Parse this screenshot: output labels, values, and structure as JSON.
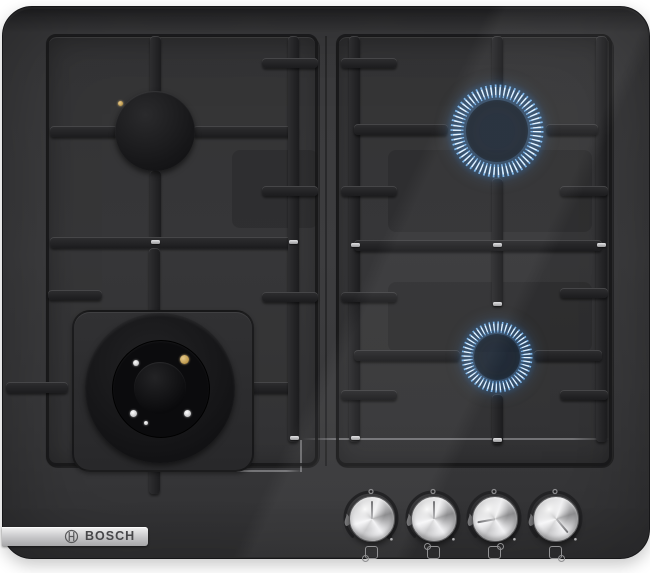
{
  "brand": {
    "name": "BOSCH",
    "logo_icon": "bosch-armature-icon"
  },
  "appliance": {
    "kind": "built-in 4-burner gas hob",
    "surface": "black tempered glass",
    "burner_count": 4,
    "knob_count": 4
  },
  "colors": {
    "glass": "#3b3b3d",
    "grid_iron": "#232325",
    "flame_tip": "#eaf6ff",
    "flame_body": "#7db6ea",
    "flame_glow": "#2f7fd4",
    "knob_metal": "#d9d9db",
    "badge_metal": "#c6c6c8",
    "igniter_brass": "#b58f4e"
  },
  "burners": [
    {
      "name": "back-left",
      "position": "top-left",
      "kind": "standard cap burner",
      "lit": false
    },
    {
      "name": "back-right",
      "position": "top-right",
      "kind": "standard burner",
      "lit": true
    },
    {
      "name": "front-left",
      "position": "bottom-left",
      "kind": "wok dual-flame burner",
      "lit": false
    },
    {
      "name": "front-right",
      "position": "bottom-right",
      "kind": "standard burner",
      "lit": true
    }
  ],
  "knobs": [
    {
      "label": "front-left burner knob",
      "state": "off",
      "pointer_deg": 0,
      "position_icon": "dot-bottom-left"
    },
    {
      "label": "back-left burner knob",
      "state": "off",
      "pointer_deg": 0,
      "position_icon": "dot-top-left"
    },
    {
      "label": "back-right burner knob",
      "state": "on",
      "pointer_deg": -100,
      "position_icon": "dot-top-right"
    },
    {
      "label": "front-right burner knob",
      "state": "on",
      "pointer_deg": 140,
      "position_icon": "dot-bottom-right"
    }
  ],
  "knob_markings": {
    "top_marker": "off-position-dot",
    "left_marker": "large-flame-icon",
    "arc_end_marker": "small-flame-dot"
  }
}
